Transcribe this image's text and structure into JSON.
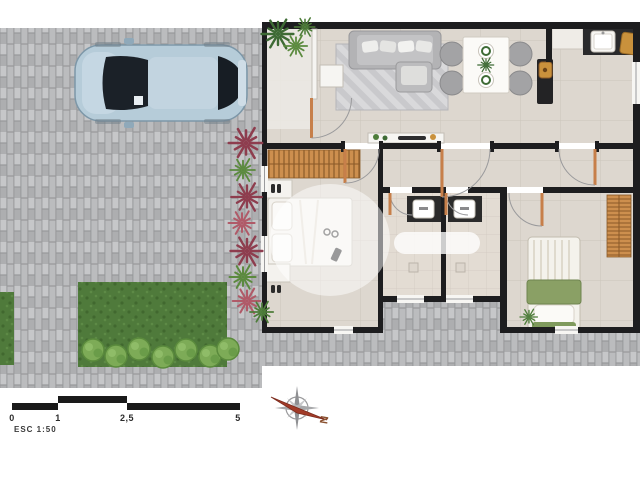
{
  "title": "residential-floor-plan",
  "scale_bar": {
    "labels": [
      "0",
      "1",
      "2,5",
      "5"
    ],
    "esc_label": "ESC 1:50"
  },
  "compass": {
    "label": "N"
  },
  "palette": {
    "background": "#ffffff",
    "paving_base": "#b4b5b7",
    "paving_joint": "#97989a",
    "wall": "#1d1d1f",
    "floor_tile": "#ddd7cf",
    "grout": "#ccc5bb",
    "bath_tile": "#e3dcd3",
    "wood": "#cd8f4e",
    "wood_line": "#8a5a28",
    "grass": "#4f7a3b",
    "hedge": "#7dab57",
    "car_body": "#b6ccd9",
    "car_glass": "#1b2128",
    "plant_red": "#8e3d4e",
    "plant_pink": "#b05a68",
    "plant_green": "#5b8a3e",
    "counter_dark": "#2a2a2c",
    "sofa_gray": "#b3b3b5",
    "bed_green": "#8aa065",
    "gold": "#c9913c",
    "needle_red": "#a23b28"
  },
  "icons": {
    "car": "top-view-sedan shape",
    "sofa": "rounded-rect shape",
    "dining-set": "table with four round chairs",
    "double-bed": "rounded-rect with pillows",
    "single-bed": "rounded-rect with green blanket",
    "vanity-sink": "dark counter with white basin",
    "compass-rose": "star with red needle",
    "scale-bar": "alternating black segments"
  }
}
